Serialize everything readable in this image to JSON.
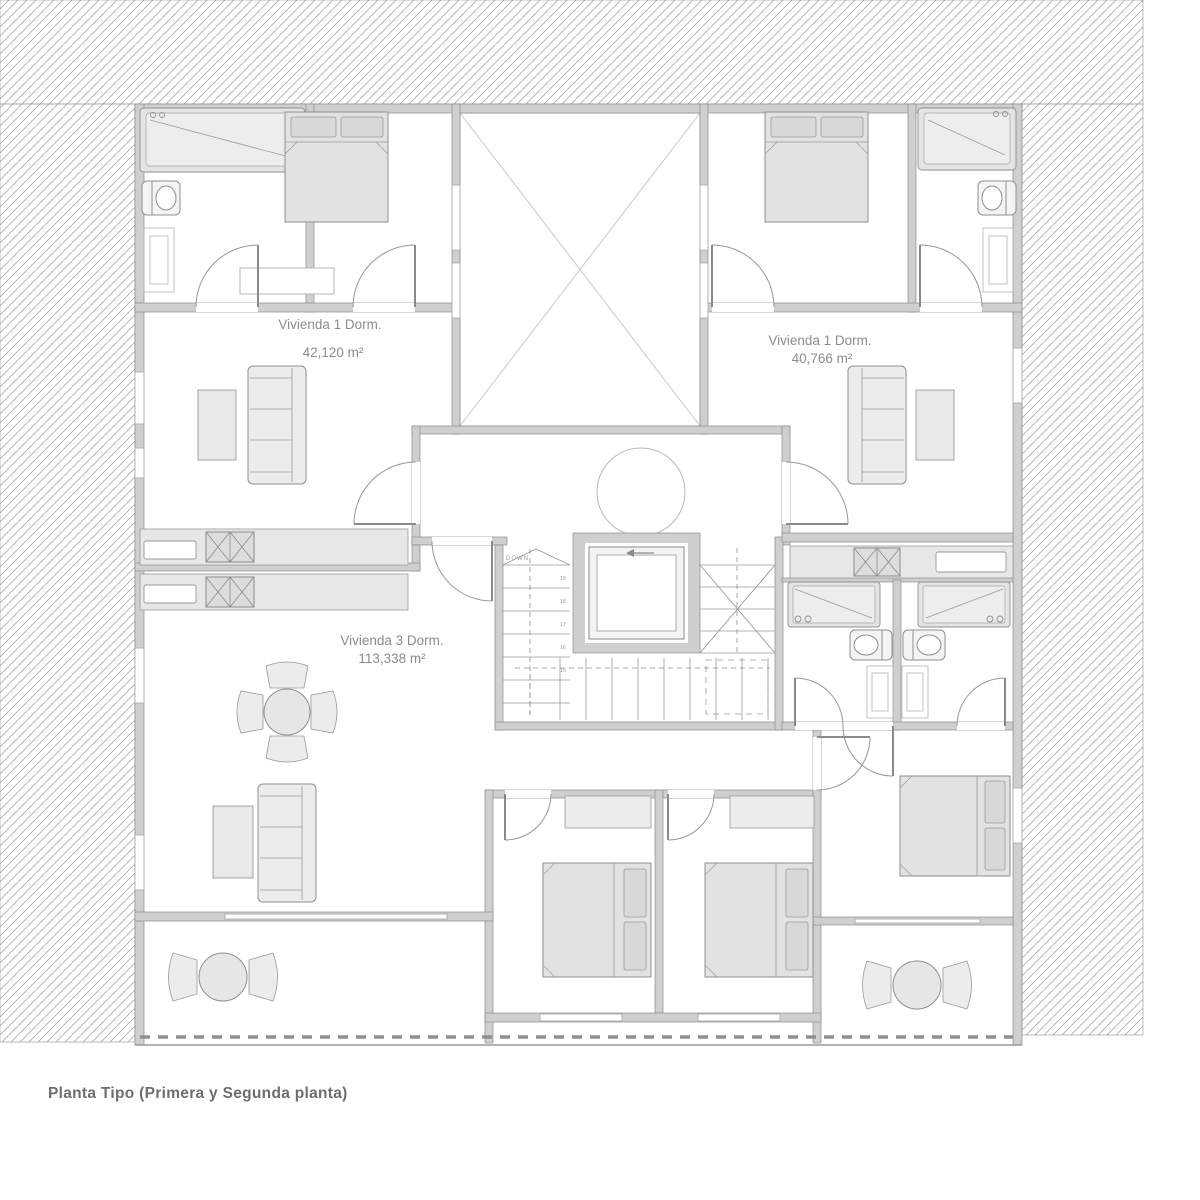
{
  "caption": "Planta Tipo (Primera y Segunda planta)",
  "units": {
    "a": {
      "name": "Vivienda 1 Dorm.",
      "area": "42,120 m²"
    },
    "b": {
      "name": "Vivienda 1 Dorm.",
      "area": "40,766 m²"
    },
    "c": {
      "name": "Vivienda 3 Dorm.",
      "area": "113,338 m²"
    }
  },
  "stairs": {
    "down_label": "DOWN",
    "tread_numbers": [
      "19",
      "18",
      "17",
      "16",
      "15"
    ]
  },
  "elevator": {
    "direction_icon": "left-arrow-icon"
  },
  "colors": {
    "wall_fill": "#cfcfcf",
    "wall_stroke": "#8b8b8b",
    "hatch_line": "#a9a9a9",
    "furniture_fill": "#e4e4e4",
    "label_text": "#8c8c8c",
    "caption_text": "#6e6e6e"
  }
}
